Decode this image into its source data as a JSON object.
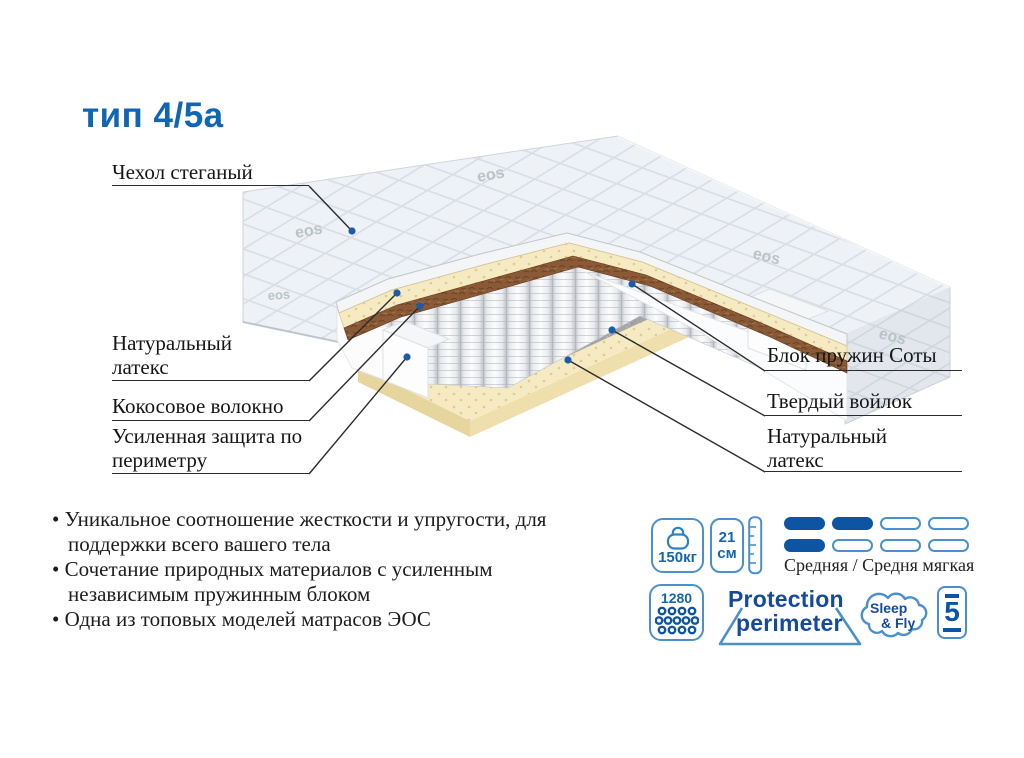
{
  "title": "тип 4/5а",
  "fabric_logo": "eos",
  "labels": {
    "cover": "Чехол стеганый",
    "latex_left": "Натуральный латекс",
    "coir": "Кокосовое волокно",
    "perimeter": "Усиленная защита по периметру",
    "springs": "Блок пружин Соты",
    "felt": "Твердый войлок",
    "latex_right": "Натуральный латекс"
  },
  "features": [
    "Уникальное соотношение жесткости и упругости, для поддержки всего вашего тела",
    "Сочетание природных материалов с усиленным независимым пружинным блоком",
    "Одна из топовых моделей матрасов ЭОС"
  ],
  "badges": {
    "max_weight": {
      "value": "150кг"
    },
    "height": {
      "value": "21",
      "unit": "см"
    },
    "firmness": {
      "caption": "Средняя / Средня мягкая",
      "rows": [
        [
          true,
          true,
          false,
          false
        ],
        [
          true,
          false,
          false,
          false
        ]
      ]
    },
    "springs_count": {
      "value": "1280"
    },
    "protection": {
      "line1": "Protection",
      "line2": "perimeter"
    },
    "brand": {
      "line1": "Sleep",
      "line2": "& Fly"
    },
    "warranty": {
      "value": "5"
    }
  },
  "colors": {
    "accent_blue": "#1066b2",
    "dark_blue": "#0d55a2",
    "light_blue": "#4a90cc",
    "brand_text": "#164a9b",
    "leader_line": "#2b2b2b",
    "dot_blue": "#1a5ca8",
    "latex": "#f3e8bd",
    "coir": "#8a5a36",
    "felt": "#a6a6a8"
  }
}
